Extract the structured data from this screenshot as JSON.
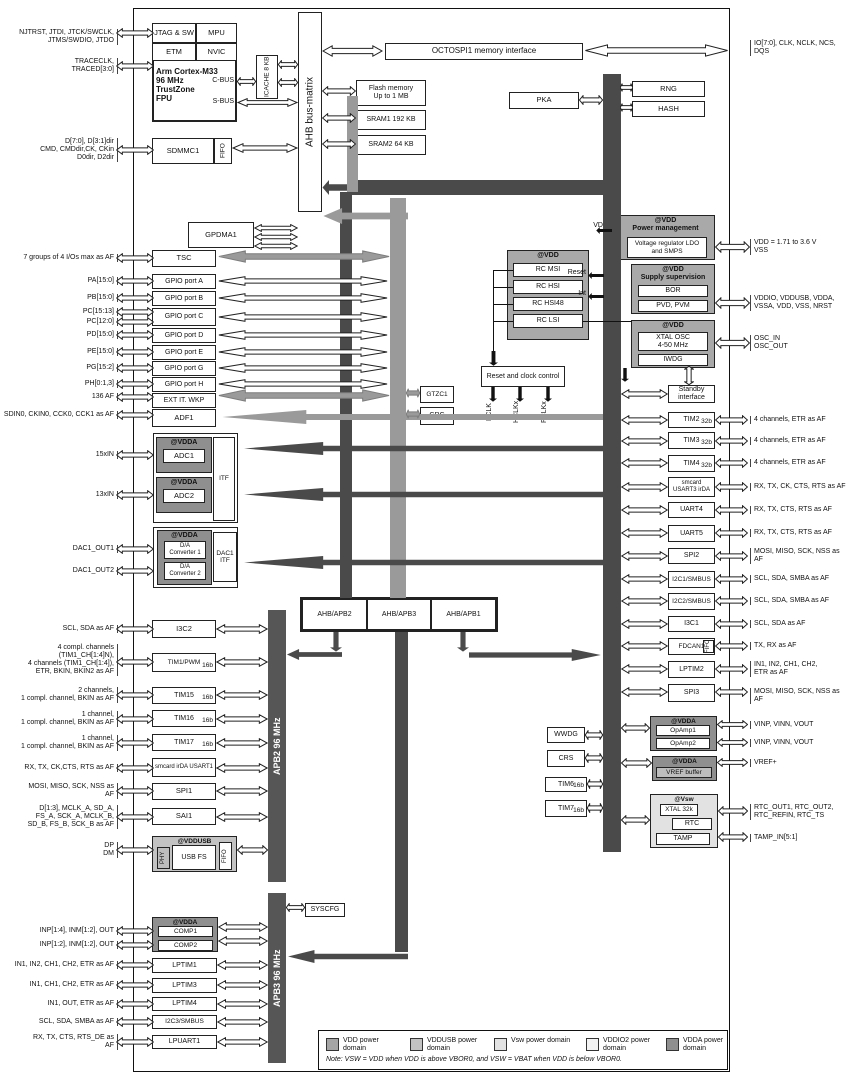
{
  "blocks": {
    "frame": {
      "label": ""
    },
    "jtag": {
      "label": "JTAG & SW"
    },
    "mpu": {
      "label": "MPU"
    },
    "etm": {
      "label": "ETM"
    },
    "nvic": {
      "label": "NVIC"
    },
    "cortexbox": {
      "label": ""
    },
    "cortextxt": {
      "label": "Arm Cortex-M33\n96 MHz\nTrustZone\nFPU"
    },
    "cbus": {
      "label": "C-BUS"
    },
    "sbus": {
      "label": "S-BUS"
    },
    "icache": {
      "label": "ICACHE 8 KB"
    },
    "busmatrix": {
      "label": "AHB bus-matrix"
    },
    "sdmmc1": {
      "label": "SDMMC1"
    },
    "sdmmcfifo": {
      "label": "FIFO"
    },
    "octospi": {
      "label": "OCTOSPI1 memory interface"
    },
    "flash": {
      "label": "Flash memory\nUp to 1 MB"
    },
    "sram1": {
      "label": "SRAM1 192 KB"
    },
    "sram2": {
      "label": "SRAM2 64 KB"
    },
    "pka": {
      "label": "PKA"
    },
    "rng": {
      "label": "RNG"
    },
    "hash": {
      "label": "HASH"
    },
    "ahb2lbl": {
      "label": "AHB2 96 MHz"
    },
    "ahb1lbl": {
      "label": "AHB1 96 MHz"
    },
    "apb1lbl": {
      "label": "APB1 96 MHz (max)"
    },
    "apb2bar": {
      "label": "APB2 96 MHz"
    },
    "apb3bar": {
      "label": "APB3 96 MHz"
    },
    "gpdma1": {
      "label": "GPDMA1"
    },
    "tsc": {
      "label": "TSC"
    },
    "gpioa": {
      "label": "GPIO port A"
    },
    "gpiob": {
      "label": "GPIO port B"
    },
    "gpioc": {
      "label": "GPIO port C"
    },
    "gpiod": {
      "label": "GPIO port D"
    },
    "gpioe": {
      "label": "GPIO port E"
    },
    "gpiog": {
      "label": "GPIO port G"
    },
    "gpioh": {
      "label": "GPIO port H"
    },
    "extit": {
      "label": "EXT IT. WKP"
    },
    "adf1": {
      "label": "ADF1"
    },
    "adcouter": {
      "label": ""
    },
    "adc1c": {
      "label": "@VDDA"
    },
    "adc1": {
      "label": "ADC1"
    },
    "adcitf": {
      "label": "ITF"
    },
    "adc2c": {
      "label": "@VDDA"
    },
    "adc2": {
      "label": "ADC2"
    },
    "dacouter": {
      "label": ""
    },
    "dacc": {
      "label": "@VDDA"
    },
    "dconv1": {
      "label": "D/A\nConverter 1"
    },
    "dconv2": {
      "label": "D/A\nConverter 2"
    },
    "dacitf": {
      "label": "DAC1\nITF"
    },
    "i3c2": {
      "label": "I3C2"
    },
    "tim1": {
      "label": "TIM1/PWM",
      "tag": "16b"
    },
    "tim15": {
      "label": "TIM15",
      "tag": "16b"
    },
    "tim16": {
      "label": "TIM16",
      "tag": "16b"
    },
    "tim17": {
      "label": "TIM17",
      "tag": "16b"
    },
    "usart1": {
      "label": "smcard irDA USART1"
    },
    "spi1": {
      "label": "SPI1"
    },
    "sai1": {
      "label": "SAI1"
    },
    "usbc": {
      "label": "@VDDUSB"
    },
    "usbphy": {
      "label": "PHY"
    },
    "usbfs": {
      "label": "USB FS"
    },
    "usbfifo": {
      "label": "FIFO"
    },
    "syscfg": {
      "label": "SYSCFG"
    },
    "compc": {
      "label": "@VDDA"
    },
    "comp1": {
      "label": "COMP1"
    },
    "comp2": {
      "label": "COMP2"
    },
    "lptim1": {
      "label": "LPTIM1"
    },
    "lptim3": {
      "label": "LPTIM3"
    },
    "lptim4": {
      "label": "LPTIM4"
    },
    "i2c3": {
      "label": "I2C3/SMBUS"
    },
    "lpuart1": {
      "label": "LPUART1"
    },
    "bridgeo": {
      "label": ""
    },
    "bridge2": {
      "label": "AHB/APB2"
    },
    "bridge3": {
      "label": "AHB/APB3"
    },
    "bridge1": {
      "label": "AHB/APB1"
    },
    "gtzc1": {
      "label": "GTZC1"
    },
    "crc": {
      "label": "CRC"
    },
    "rccluster": {
      "label": "@VDD"
    },
    "rcmsi": {
      "label": "RC MSI"
    },
    "rchsi": {
      "label": "RC HSI"
    },
    "rchsi48": {
      "label": "RC HSI48"
    },
    "rclsi": {
      "label": "RC LSI"
    },
    "rcc": {
      "label": "Reset and clock control"
    },
    "fclk": {
      "label": "FCLK"
    },
    "hclkx": {
      "label": "HCLKx"
    },
    "pclkx": {
      "label": "PCLKx"
    },
    "pwrc": {
      "label": "@VDD\nPower management"
    },
    "pwrinner": {
      "label": "Voltage regulator LDO\nand SMPS"
    },
    "vddlbl": {
      "label": "VDD"
    },
    "supplyc": {
      "label": "@VDD\nSupply supervision"
    },
    "bor": {
      "label": "BOR"
    },
    "pvd": {
      "label": "PVD, PVM"
    },
    "resetlbl": {
      "label": "Reset"
    },
    "intlbl": {
      "label": "Int"
    },
    "xtalc": {
      "label": "@VDD"
    },
    "xtalosc": {
      "label": "XTAL OSC\n4-50 MHz"
    },
    "iwdg": {
      "label": "IWDG"
    },
    "standby": {
      "label": "Standby\ninterface"
    },
    "tim2": {
      "label": "TIM2",
      "tag": "32b"
    },
    "tim3": {
      "label": "TIM3",
      "tag": "32b"
    },
    "tim4": {
      "label": "TIM4",
      "tag": "32b"
    },
    "usart3": {
      "label": "smcard\nUSART3 irDA"
    },
    "uart4": {
      "label": "UART4"
    },
    "uart5": {
      "label": "UART5"
    },
    "spi2": {
      "label": "SPI2"
    },
    "i2c1": {
      "label": "I2C1/SMBUS"
    },
    "i2c2": {
      "label": "I2C2/SMBUS"
    },
    "i3c1": {
      "label": "I3C1"
    },
    "fdcan1": {
      "label": "FDCAN1"
    },
    "fdcanfifo": {
      "label": "FIFO"
    },
    "lptim2": {
      "label": "LPTIM2"
    },
    "spi3": {
      "label": "SPI3"
    },
    "wwdg": {
      "label": "WWDG"
    },
    "crs": {
      "label": "CRS"
    },
    "tim6": {
      "label": "TIM6",
      "tag": "16b"
    },
    "tim7": {
      "label": "TIM7",
      "tag": "16b"
    },
    "opampc": {
      "label": "@VDDA"
    },
    "opamp1": {
      "label": "OpAmp1"
    },
    "opamp2": {
      "label": "OpAmp2"
    },
    "vrefc": {
      "label": "@VDDA"
    },
    "vrefbuf": {
      "label": "VREF buffer"
    },
    "vswc": {
      "label": "@Vsw"
    },
    "xtal32k": {
      "label": "XTAL 32k"
    },
    "rtc": {
      "label": "RTC"
    },
    "tamp": {
      "label": "TAMP"
    },
    "legendbox": {
      "label": ""
    }
  },
  "pins_left": [
    {
      "id": "pin-jtag",
      "label": "NJTRST, JTDI, JTCK/SWCLK,\nJTMS/SWDIO, JTDO"
    },
    {
      "id": "pin-trace",
      "label": "TRACECLK,\nTRACED[3:0]"
    },
    {
      "id": "pin-sdmmc",
      "label": "D[7:0], D[3:1]dir\nCMD, CMDdir,CK, CKin\nD0dir, D2dir"
    },
    {
      "id": "pin-tsc",
      "label": "7 groups of 4 I/Os max as AF"
    },
    {
      "id": "pin-pa",
      "label": "PA[15:0]"
    },
    {
      "id": "pin-pb",
      "label": "PB[15:0]"
    },
    {
      "id": "pin-pc1",
      "label": "PC[15:13]"
    },
    {
      "id": "pin-pc2",
      "label": "PC[12:0]"
    },
    {
      "id": "pin-pd",
      "label": "PD[15:0]"
    },
    {
      "id": "pin-pe",
      "label": "PE[15:0]"
    },
    {
      "id": "pin-pg",
      "label": "PG[15:2]"
    },
    {
      "id": "pin-ph",
      "label": "PH[0:1,3]"
    },
    {
      "id": "pin-extit",
      "label": "136 AF"
    },
    {
      "id": "pin-adf1",
      "label": "SDIN0, CKIN0, CCK0, CCK1 as AF"
    },
    {
      "id": "pin-adc1",
      "label": "15xIN"
    },
    {
      "id": "pin-adc2",
      "label": "13xIN"
    },
    {
      "id": "pin-dac1",
      "label": "DAC1_OUT1"
    },
    {
      "id": "pin-dac2",
      "label": "DAC1_OUT2"
    },
    {
      "id": "pin-i3c2",
      "label": "SCL, SDA as AF"
    },
    {
      "id": "pin-tim1",
      "label": "4 compl. channels\n(TIM1_CH[1:4]N),\n4 channels (TIM1_CH[1:4]),\nETR, BKIN, BKIN2 as AF"
    },
    {
      "id": "pin-tim15",
      "label": "2 channels,\n1 compl. channel, BKIN as AF"
    },
    {
      "id": "pin-tim16",
      "label": "1 channel,\n1 compl. channel, BKIN as AF"
    },
    {
      "id": "pin-tim17",
      "label": "1 channel,\n1 compl. channel, BKIN as AF"
    },
    {
      "id": "pin-usart1",
      "label": "RX, TX, CK,CTS, RTS as AF"
    },
    {
      "id": "pin-spi1",
      "label": "MOSI, MISO, SCK, NSS as\nAF"
    },
    {
      "id": "pin-sai1",
      "label": "D[1:3], MCLK_A, SD_A,\nFS_A, SCK_A, MCLK_B,\nSD_B, FS_B, SCK_B as AF"
    },
    {
      "id": "pin-usb",
      "label": "DP\nDM"
    },
    {
      "id": "pin-comp1",
      "label": "INP[1:4], INM[1:2], OUT"
    },
    {
      "id": "pin-comp2",
      "label": "INP[1:2], INM[1:2], OUT"
    },
    {
      "id": "pin-lptim1",
      "label": "IN1, IN2, CH1, CH2, ETR as AF"
    },
    {
      "id": "pin-lptim3",
      "label": "IN1, CH1, CH2, ETR as AF"
    },
    {
      "id": "pin-lptim4",
      "label": "IN1, OUT, ETR as AF"
    },
    {
      "id": "pin-i2c3",
      "label": "SCL, SDA, SMBA as AF"
    },
    {
      "id": "pin-lpuart1",
      "label": "RX, TX, CTS, RTS_DE as\nAF"
    }
  ],
  "pins_right": [
    {
      "id": "pin-octospi",
      "label": "IO[7:0], CLK, NCLK, NCS,\nDQS"
    },
    {
      "id": "pin-vdd",
      "label": "VDD = 1.71 to 3.6 V\nVSS"
    },
    {
      "id": "pin-vddio",
      "label": "VDDIO, VDDUSB, VDDA,\nVSSA, VDD, VSS, NRST"
    },
    {
      "id": "pin-osc",
      "label": "OSC_IN\nOSC_OUT"
    },
    {
      "id": "pin-tim2",
      "label": "4 channels, ETR as AF"
    },
    {
      "id": "pin-tim3",
      "label": "4 channels, ETR as AF"
    },
    {
      "id": "pin-tim4",
      "label": "4 channels, ETR as AF"
    },
    {
      "id": "pin-usart3",
      "label": "RX, TX, CK, CTS, RTS as AF"
    },
    {
      "id": "pin-uart4",
      "label": "RX, TX, CTS, RTS as AF"
    },
    {
      "id": "pin-uart5",
      "label": "RX, TX, CTS, RTS as AF"
    },
    {
      "id": "pin-spi2",
      "label": "MOSI, MISO, SCK, NSS as\nAF"
    },
    {
      "id": "pin-i2c1",
      "label": "SCL, SDA, SMBA as AF"
    },
    {
      "id": "pin-i2c2",
      "label": "SCL, SDA, SMBA as AF"
    },
    {
      "id": "pin-i3c1",
      "label": "SCL, SDA as AF"
    },
    {
      "id": "pin-fdcan1",
      "label": "TX, RX as AF"
    },
    {
      "id": "pin-lptim2",
      "label": "IN1, IN2, CH1, CH2,\nETR as AF"
    },
    {
      "id": "pin-spi3",
      "label": "MOSI, MISO, SCK, NSS as AF"
    },
    {
      "id": "pin-opamp1",
      "label": "VINP, VINN, VOUT"
    },
    {
      "id": "pin-opamp2",
      "label": "VINP, VINN, VOUT"
    },
    {
      "id": "pin-vref",
      "label": "VREF+"
    },
    {
      "id": "pin-rtc",
      "label": "RTC_OUT1, RTC_OUT2,\nRTC_REFIN, RTC_TS"
    },
    {
      "id": "pin-tamp",
      "label": "TAMP_IN[5:1]"
    }
  ],
  "legend": {
    "items": [
      {
        "label": "VDD power\ndomain",
        "color": "#a5a5a5"
      },
      {
        "label": "VDDUSB power\ndomain",
        "color": "#c3c3c3"
      },
      {
        "label": "Vsw power domain",
        "color": "#e2e2e2"
      },
      {
        "label": "VDDIO2 power\ndomain",
        "color": "#f3f3f3"
      },
      {
        "label": "VDDA power\ndomain",
        "color": "#8f8f8f"
      }
    ],
    "note": "Note:  VSW = VDD when VDD is above VBOR0, and VSW = VBAT when VDD is below VBOR0."
  },
  "colors": {
    "dark_bus": "#4a4a4a",
    "gray_bus": "#9a9a9a",
    "apb_bar": "#565656"
  }
}
